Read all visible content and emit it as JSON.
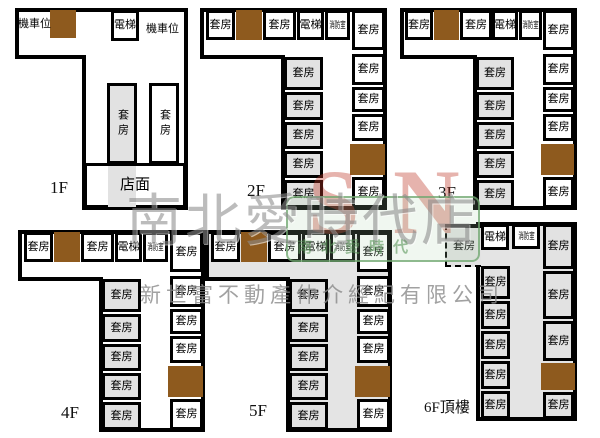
{
  "watermark": {
    "store_name": "南北愛時代店",
    "company_name": "新世富不動產仲介經紀有限公司",
    "logo_letters": "SN",
    "logo_subtext": "南北愛時代",
    "green": "#6ea56e",
    "red": "#be3728",
    "gray": "#8a8a8a"
  },
  "colors": {
    "wall": "#000000",
    "stair_brown": "#8e5a1e",
    "room_gray": "#e2e2e2",
    "background": "#ffffff"
  },
  "floors": [
    {
      "id": "1F",
      "label": "1F",
      "label_x": 50,
      "label_y": 178,
      "outline": "17,10 186,10 186,208 84,208 84,57 17,57",
      "corridor": "white",
      "rooms": [
        {
          "t": "text",
          "n": "motorcycle-parking-label",
          "label": "機車位",
          "x": 18,
          "y": 15
        },
        {
          "t": "brown",
          "x": 50,
          "y": 10,
          "w": 26,
          "h": 28
        },
        {
          "t": "room",
          "n": "elevator-room",
          "label": "電梯",
          "x": 111,
          "y": 10,
          "w": 28,
          "h": 31
        },
        {
          "t": "text",
          "n": "motorcycle-parking-label",
          "label": "機車位",
          "x": 146,
          "y": 20
        },
        {
          "t": "room",
          "n": "suite-room",
          "label": "套房",
          "x": 107,
          "y": 83,
          "w": 30,
          "h": 81,
          "fill": "gray",
          "v": 1
        },
        {
          "t": "room",
          "n": "suite-room",
          "label": "套房",
          "x": 149,
          "y": 83,
          "w": 30,
          "h": 81,
          "v": 1
        },
        {
          "t": "room",
          "n": "storefront-room",
          "label": "店面",
          "x": 84,
          "y": 163,
          "w": 102,
          "h": 45,
          "fs": 15
        },
        {
          "t": "shade",
          "x": 108,
          "y": 166,
          "w": 28,
          "h": 41
        }
      ]
    },
    {
      "id": "2F",
      "label": "2F",
      "label_x": 247,
      "label_y": 181,
      "outline": "202,10 385,10 385,208 283,208 283,57 202,57",
      "corridor": "white",
      "rooms": [
        {
          "t": "room",
          "n": "suite-room",
          "label": "套房",
          "x": 206,
          "y": 10,
          "w": 29,
          "h": 30
        },
        {
          "t": "brown",
          "x": 236,
          "y": 10,
          "w": 26,
          "h": 30
        },
        {
          "t": "room",
          "n": "suite-room",
          "label": "套房",
          "x": 263,
          "y": 10,
          "w": 33,
          "h": 30
        },
        {
          "t": "room",
          "n": "elevator-room",
          "label": "電梯",
          "x": 297,
          "y": 10,
          "w": 27,
          "h": 30
        },
        {
          "t": "room",
          "n": "fire-safety-room",
          "label": "消防室",
          "x": 325,
          "y": 10,
          "w": 25,
          "h": 30,
          "s": 1
        },
        {
          "t": "room",
          "n": "suite-room",
          "label": "套房",
          "x": 352,
          "y": 10,
          "w": 33,
          "h": 40
        },
        {
          "t": "room",
          "n": "suite-room",
          "label": "套房",
          "x": 352,
          "y": 54,
          "w": 33,
          "h": 31
        },
        {
          "t": "room",
          "n": "suite-room",
          "label": "套房",
          "x": 352,
          "y": 87,
          "w": 33,
          "h": 25
        },
        {
          "t": "room",
          "n": "suite-room",
          "label": "套房",
          "x": 352,
          "y": 114,
          "w": 33,
          "h": 27
        },
        {
          "t": "brown",
          "x": 350,
          "y": 144,
          "w": 35,
          "h": 31
        },
        {
          "t": "room",
          "n": "suite-room",
          "label": "套房",
          "x": 352,
          "y": 177,
          "w": 33,
          "h": 31
        },
        {
          "t": "room",
          "n": "suite-room",
          "label": "套房",
          "x": 284,
          "y": 57,
          "w": 39,
          "h": 33,
          "fill": "gray"
        },
        {
          "t": "room",
          "n": "suite-room",
          "label": "套房",
          "x": 284,
          "y": 92,
          "w": 39,
          "h": 28,
          "fill": "gray"
        },
        {
          "t": "room",
          "n": "suite-room",
          "label": "套房",
          "x": 284,
          "y": 122,
          "w": 39,
          "h": 27,
          "fill": "gray"
        },
        {
          "t": "room",
          "n": "suite-room",
          "label": "套房",
          "x": 284,
          "y": 151,
          "w": 39,
          "h": 27,
          "fill": "gray"
        },
        {
          "t": "room",
          "n": "suite-room",
          "label": "套房",
          "x": 284,
          "y": 180,
          "w": 39,
          "h": 28,
          "fill": "gray"
        }
      ]
    },
    {
      "id": "3F",
      "label": "3F",
      "label_x": 438,
      "label_y": 183,
      "outline": "402,10 575,10 575,208 475,208 475,57 402,57",
      "corridor": "white",
      "rooms": [
        {
          "t": "room",
          "n": "suite-room",
          "label": "套房",
          "x": 405,
          "y": 10,
          "w": 28,
          "h": 30
        },
        {
          "t": "brown",
          "x": 434,
          "y": 10,
          "w": 25,
          "h": 30
        },
        {
          "t": "room",
          "n": "suite-room",
          "label": "套房",
          "x": 460,
          "y": 10,
          "w": 32,
          "h": 30
        },
        {
          "t": "room",
          "n": "elevator-room",
          "label": "電梯",
          "x": 492,
          "y": 10,
          "w": 26,
          "h": 30
        },
        {
          "t": "room",
          "n": "fire-safety-room",
          "label": "消防室",
          "x": 519,
          "y": 10,
          "w": 23,
          "h": 30,
          "s": 1
        },
        {
          "t": "room",
          "n": "suite-room",
          "label": "套房",
          "x": 543,
          "y": 10,
          "w": 31,
          "h": 40
        },
        {
          "t": "room",
          "n": "suite-room",
          "label": "套房",
          "x": 543,
          "y": 54,
          "w": 31,
          "h": 31
        },
        {
          "t": "room",
          "n": "suite-room",
          "label": "套房",
          "x": 543,
          "y": 87,
          "w": 31,
          "h": 25
        },
        {
          "t": "room",
          "n": "suite-room",
          "label": "套房",
          "x": 543,
          "y": 114,
          "w": 31,
          "h": 27
        },
        {
          "t": "brown",
          "x": 541,
          "y": 144,
          "w": 33,
          "h": 31
        },
        {
          "t": "room",
          "n": "suite-room",
          "label": "套房",
          "x": 543,
          "y": 177,
          "w": 31,
          "h": 31
        },
        {
          "t": "room",
          "n": "suite-room",
          "label": "套房",
          "x": 476,
          "y": 57,
          "w": 38,
          "h": 33,
          "fill": "gray"
        },
        {
          "t": "room",
          "n": "suite-room",
          "label": "套房",
          "x": 476,
          "y": 92,
          "w": 38,
          "h": 28,
          "fill": "gray"
        },
        {
          "t": "room",
          "n": "suite-room",
          "label": "套房",
          "x": 476,
          "y": 122,
          "w": 38,
          "h": 27,
          "fill": "gray"
        },
        {
          "t": "room",
          "n": "suite-room",
          "label": "套房",
          "x": 476,
          "y": 151,
          "w": 38,
          "h": 27,
          "fill": "gray"
        },
        {
          "t": "room",
          "n": "suite-room",
          "label": "套房",
          "x": 476,
          "y": 180,
          "w": 38,
          "h": 28,
          "fill": "gray"
        }
      ]
    },
    {
      "id": "4F",
      "label": "4F",
      "label_x": 61,
      "label_y": 403,
      "outline": "20,232 203,232 203,430 101,430 101,279 20,279",
      "corridor": "white",
      "rooms": [
        {
          "t": "room",
          "n": "suite-room",
          "label": "套房",
          "x": 24,
          "y": 232,
          "w": 29,
          "h": 30
        },
        {
          "t": "brown",
          "x": 54,
          "y": 232,
          "w": 26,
          "h": 30
        },
        {
          "t": "room",
          "n": "suite-room",
          "label": "套房",
          "x": 81,
          "y": 232,
          "w": 33,
          "h": 30
        },
        {
          "t": "room",
          "n": "elevator-room",
          "label": "電梯",
          "x": 115,
          "y": 232,
          "w": 27,
          "h": 30
        },
        {
          "t": "room",
          "n": "fire-safety-room",
          "label": "消防室",
          "x": 143,
          "y": 232,
          "w": 25,
          "h": 30,
          "s": 1
        },
        {
          "t": "room",
          "n": "suite-room",
          "label": "套房",
          "x": 170,
          "y": 232,
          "w": 33,
          "h": 40
        },
        {
          "t": "room",
          "n": "suite-room",
          "label": "套房",
          "x": 170,
          "y": 276,
          "w": 33,
          "h": 31
        },
        {
          "t": "room",
          "n": "suite-room",
          "label": "套房",
          "x": 170,
          "y": 309,
          "w": 33,
          "h": 25
        },
        {
          "t": "room",
          "n": "suite-room",
          "label": "套房",
          "x": 170,
          "y": 336,
          "w": 33,
          "h": 27
        },
        {
          "t": "brown",
          "x": 168,
          "y": 366,
          "w": 35,
          "h": 31
        },
        {
          "t": "room",
          "n": "suite-room",
          "label": "套房",
          "x": 170,
          "y": 399,
          "w": 33,
          "h": 31
        },
        {
          "t": "room",
          "n": "suite-room",
          "label": "套房",
          "x": 102,
          "y": 279,
          "w": 39,
          "h": 33,
          "fill": "gray"
        },
        {
          "t": "room",
          "n": "suite-room",
          "label": "套房",
          "x": 102,
          "y": 314,
          "w": 39,
          "h": 28,
          "fill": "gray"
        },
        {
          "t": "room",
          "n": "suite-room",
          "label": "套房",
          "x": 102,
          "y": 344,
          "w": 39,
          "h": 27,
          "fill": "gray"
        },
        {
          "t": "room",
          "n": "suite-room",
          "label": "套房",
          "x": 102,
          "y": 373,
          "w": 39,
          "h": 27,
          "fill": "gray"
        },
        {
          "t": "room",
          "n": "suite-room",
          "label": "套房",
          "x": 102,
          "y": 402,
          "w": 39,
          "h": 28,
          "fill": "gray"
        }
      ]
    },
    {
      "id": "5F",
      "label": "5F",
      "label_x": 249,
      "label_y": 401,
      "outline": "207,232 390,232 390,430 288,430 288,279 207,279",
      "corridor": "gray",
      "rooms": [
        {
          "t": "room",
          "n": "suite-room",
          "label": "套房",
          "x": 211,
          "y": 232,
          "w": 29,
          "h": 30
        },
        {
          "t": "brown",
          "x": 241,
          "y": 232,
          "w": 26,
          "h": 30
        },
        {
          "t": "room",
          "n": "suite-room",
          "label": "套房",
          "x": 268,
          "y": 232,
          "w": 33,
          "h": 30
        },
        {
          "t": "room",
          "n": "elevator-room",
          "label": "電梯",
          "x": 302,
          "y": 232,
          "w": 27,
          "h": 30
        },
        {
          "t": "room",
          "n": "fire-safety-room",
          "label": "消防室",
          "x": 330,
          "y": 232,
          "w": 25,
          "h": 30,
          "s": 1
        },
        {
          "t": "room",
          "n": "suite-room",
          "label": "套房",
          "x": 357,
          "y": 232,
          "w": 33,
          "h": 40
        },
        {
          "t": "room",
          "n": "suite-room",
          "label": "套房",
          "x": 357,
          "y": 276,
          "w": 33,
          "h": 31
        },
        {
          "t": "room",
          "n": "suite-room",
          "label": "套房",
          "x": 357,
          "y": 309,
          "w": 33,
          "h": 25
        },
        {
          "t": "room",
          "n": "suite-room",
          "label": "套房",
          "x": 357,
          "y": 336,
          "w": 33,
          "h": 27
        },
        {
          "t": "brown",
          "x": 355,
          "y": 366,
          "w": 35,
          "h": 31
        },
        {
          "t": "room",
          "n": "suite-room",
          "label": "套房",
          "x": 357,
          "y": 399,
          "w": 33,
          "h": 31
        },
        {
          "t": "room",
          "n": "suite-room",
          "label": "套房",
          "x": 289,
          "y": 279,
          "w": 39,
          "h": 33,
          "fill": "gray"
        },
        {
          "t": "room",
          "n": "suite-room",
          "label": "套房",
          "x": 289,
          "y": 314,
          "w": 39,
          "h": 28,
          "fill": "gray"
        },
        {
          "t": "room",
          "n": "suite-room",
          "label": "套房",
          "x": 289,
          "y": 344,
          "w": 39,
          "h": 27,
          "fill": "gray"
        },
        {
          "t": "room",
          "n": "suite-room",
          "label": "套房",
          "x": 289,
          "y": 373,
          "w": 39,
          "h": 27,
          "fill": "gray"
        },
        {
          "t": "room",
          "n": "suite-room",
          "label": "套房",
          "x": 289,
          "y": 402,
          "w": 39,
          "h": 28,
          "fill": "gray"
        }
      ]
    },
    {
      "id": "6F",
      "label": "6F頂樓",
      "label_x": 424,
      "label_y": 396,
      "label_fs": 15,
      "outline": "478,224 575,224 575,419 478,419",
      "corridor": "gray",
      "rooms": [
        {
          "t": "room",
          "n": "suite-room",
          "label": "套房",
          "x": 445,
          "y": 224,
          "w": 36,
          "h": 43,
          "fill": "gray",
          "cls": "protrude"
        },
        {
          "t": "room",
          "n": "elevator-room",
          "label": "電梯",
          "x": 481,
          "y": 224,
          "w": 28,
          "h": 26
        },
        {
          "t": "room",
          "n": "fire-safety-room",
          "label": "消防室",
          "x": 512,
          "y": 224,
          "w": 28,
          "h": 25,
          "s": 1
        },
        {
          "t": "room",
          "n": "suite-room",
          "label": "套房",
          "x": 543,
          "y": 224,
          "w": 31,
          "h": 45,
          "fill": "gray"
        },
        {
          "t": "room",
          "n": "suite-room",
          "label": "套房",
          "x": 481,
          "y": 266,
          "w": 29,
          "h": 33,
          "fill": "gray"
        },
        {
          "t": "room",
          "n": "suite-room",
          "label": "套房",
          "x": 481,
          "y": 301,
          "w": 29,
          "h": 28,
          "fill": "gray"
        },
        {
          "t": "room",
          "n": "suite-room",
          "label": "套房",
          "x": 481,
          "y": 331,
          "w": 29,
          "h": 28,
          "fill": "gray"
        },
        {
          "t": "room",
          "n": "suite-room",
          "label": "套房",
          "x": 481,
          "y": 361,
          "w": 29,
          "h": 28,
          "fill": "gray"
        },
        {
          "t": "room",
          "n": "suite-room",
          "label": "套房",
          "x": 481,
          "y": 391,
          "w": 29,
          "h": 28,
          "fill": "gray"
        },
        {
          "t": "room",
          "n": "suite-room",
          "label": "套房",
          "x": 543,
          "y": 271,
          "w": 31,
          "h": 48,
          "fill": "gray"
        },
        {
          "t": "room",
          "n": "suite-room",
          "label": "套房",
          "x": 543,
          "y": 321,
          "w": 31,
          "h": 40,
          "fill": "gray"
        },
        {
          "t": "brown",
          "x": 541,
          "y": 363,
          "w": 34,
          "h": 27
        },
        {
          "t": "room",
          "n": "suite-room",
          "label": "套房",
          "x": 543,
          "y": 392,
          "w": 31,
          "h": 27,
          "fill": "gray"
        }
      ]
    }
  ]
}
